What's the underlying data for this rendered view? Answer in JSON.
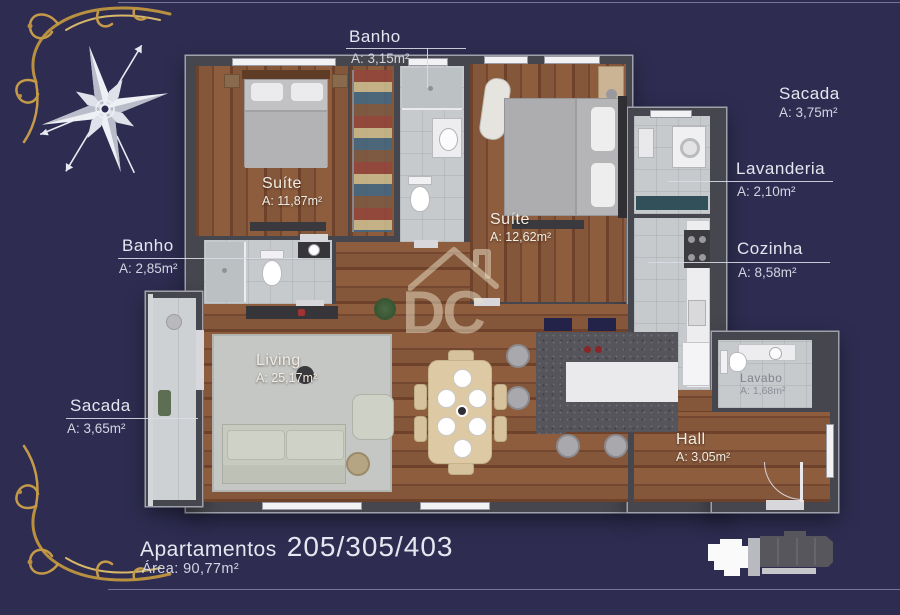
{
  "labels": {
    "banho_top": {
      "name": "Banho",
      "area": "A: 3,15m²"
    },
    "sacada_top": {
      "name": "Sacada",
      "area": "A: 3,75m²"
    },
    "lavanderia": {
      "name": "Lavanderia",
      "area": "A: 2,10m²"
    },
    "cozinha": {
      "name": "Cozinha",
      "area": "A: 8,58m²"
    },
    "banho_left": {
      "name": "Banho",
      "area": "A: 2,85m²"
    },
    "suite_1": {
      "name": "Suíte",
      "area": "A: 11,87m²"
    },
    "suite_2": {
      "name": "Suíte",
      "area": "A: 12,62m²"
    },
    "living": {
      "name": "Living",
      "area": "A: 25,17m²"
    },
    "sacada_left": {
      "name": "Sacada",
      "area": "A: 3,65m²"
    },
    "lavabo": {
      "name": "Lavabo",
      "area": "A: 1,68m²"
    },
    "hall": {
      "name": "Hall",
      "area": "A: 3,05m²"
    }
  },
  "footer": {
    "building_label": "Apartamentos",
    "units": "205/305/403",
    "total_area": "Área: 90,77m²"
  },
  "watermark": {
    "text": "DC"
  },
  "icons": {
    "compass": "compass-rose",
    "corner_ornament": "gold-flourish",
    "watermark_logo": "dc-house-logo",
    "keyplan": "building-footprint"
  },
  "colors": {
    "background": "#2e2d51",
    "text": "#e5e6f0",
    "gold": "#b8903f",
    "wood": "#7d4e31",
    "tile": "#c7cacc",
    "wall": "#46464e",
    "wall-edge": "#a0a1ac",
    "granite": "#55555b"
  }
}
